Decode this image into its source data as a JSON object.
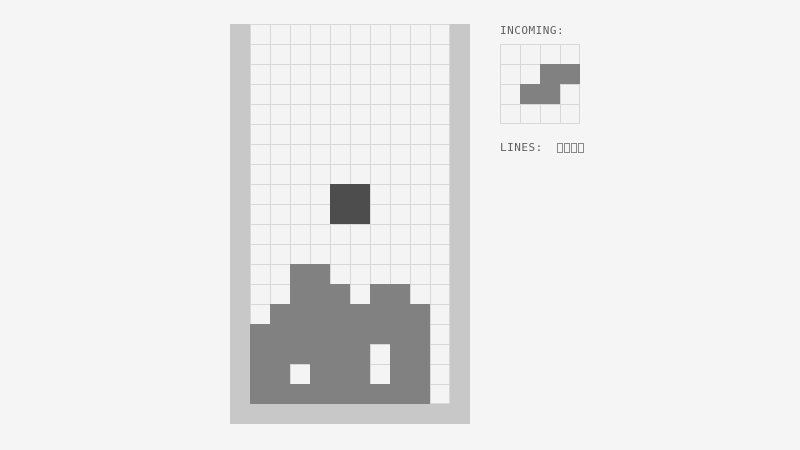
{
  "colors": {
    "background": "#f5f5f5",
    "wall": "#c8c8c8",
    "grid_line": "#d8d8d8",
    "cell_fill": "#f4f4f4",
    "pile": "#818181",
    "active_piece": "#4d4d4d",
    "incoming_piece": "#818181",
    "label_text": "#606060",
    "counter_box_border": "#8a8a8a"
  },
  "board": {
    "columns": 10,
    "rows": 19,
    "cell_size_px": 20,
    "pile_cells": [
      [
        12,
        2
      ],
      [
        12,
        3
      ],
      [
        13,
        2
      ],
      [
        13,
        3
      ],
      [
        13,
        4
      ],
      [
        13,
        6
      ],
      [
        13,
        7
      ],
      [
        14,
        1
      ],
      [
        14,
        2
      ],
      [
        14,
        3
      ],
      [
        14,
        4
      ],
      [
        14,
        5
      ],
      [
        14,
        6
      ],
      [
        14,
        7
      ],
      [
        14,
        8
      ],
      [
        15,
        0
      ],
      [
        15,
        1
      ],
      [
        15,
        2
      ],
      [
        15,
        3
      ],
      [
        15,
        4
      ],
      [
        15,
        5
      ],
      [
        15,
        6
      ],
      [
        15,
        7
      ],
      [
        15,
        8
      ],
      [
        16,
        0
      ],
      [
        16,
        1
      ],
      [
        16,
        2
      ],
      [
        16,
        3
      ],
      [
        16,
        4
      ],
      [
        16,
        5
      ],
      [
        16,
        7
      ],
      [
        16,
        8
      ],
      [
        17,
        0
      ],
      [
        17,
        1
      ],
      [
        17,
        3
      ],
      [
        17,
        4
      ],
      [
        17,
        5
      ],
      [
        17,
        7
      ],
      [
        17,
        8
      ],
      [
        18,
        0
      ],
      [
        18,
        1
      ],
      [
        18,
        2
      ],
      [
        18,
        3
      ],
      [
        18,
        4
      ],
      [
        18,
        5
      ],
      [
        18,
        6
      ],
      [
        18,
        7
      ],
      [
        18,
        8
      ]
    ],
    "active_piece": {
      "shape": "O",
      "cells": [
        [
          8,
          4
        ],
        [
          8,
          5
        ],
        [
          9,
          4
        ],
        [
          9,
          5
        ]
      ]
    }
  },
  "incoming": {
    "label": "INCOMING:",
    "grid": {
      "columns": 4,
      "rows": 4,
      "cell_size_px": 20
    },
    "piece": {
      "shape": "S",
      "cells": [
        [
          1,
          2
        ],
        [
          1,
          3
        ],
        [
          2,
          1
        ],
        [
          2,
          2
        ]
      ]
    }
  },
  "lines": {
    "label": "LINES:",
    "value": "0000"
  }
}
